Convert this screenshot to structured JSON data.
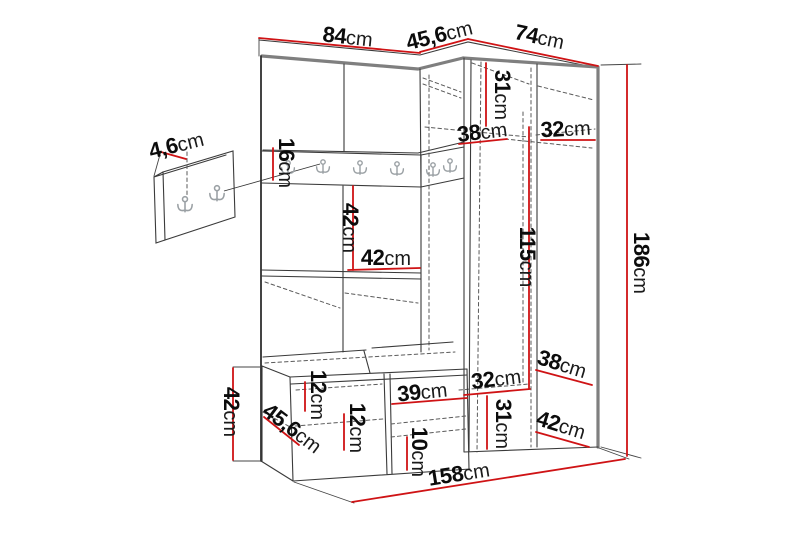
{
  "diagram": {
    "description": "Hallway furniture set dimension drawing",
    "unit": "cm",
    "labels": {
      "top_width_left": {
        "num": "84",
        "unit": "cm"
      },
      "top_width_corner": {
        "num": "45,6",
        "unit": "cm"
      },
      "top_width_right": {
        "num": "74",
        "unit": "cm"
      },
      "panel_depth": {
        "num": "4,6",
        "unit": "cm"
      },
      "rail_height": {
        "num": "16",
        "unit": "cm"
      },
      "upper_inner_height": {
        "num": "31",
        "unit": "cm"
      },
      "upper_shelf_left": {
        "num": "38",
        "unit": "cm"
      },
      "upper_shelf_right": {
        "num": "32",
        "unit": "cm"
      },
      "niche_height": {
        "num": "42",
        "unit": "cm"
      },
      "niche_width": {
        "num": "42",
        "unit": "cm"
      },
      "hanging_height": {
        "num": "115",
        "unit": "cm"
      },
      "total_height": {
        "num": "186",
        "unit": "cm"
      },
      "lower_shelf_left": {
        "num": "32",
        "unit": "cm"
      },
      "lower_shelf_right": {
        "num": "38",
        "unit": "cm"
      },
      "lower_inner_height": {
        "num": "31",
        "unit": "cm"
      },
      "lower_depth": {
        "num": "42",
        "unit": "cm"
      },
      "bench_height": {
        "num": "42",
        "unit": "cm"
      },
      "bench_depth": {
        "num": "45,6",
        "unit": "cm"
      },
      "bench_top_height": {
        "num": "12",
        "unit": "cm"
      },
      "bench_inner_height": {
        "num": "12",
        "unit": "cm"
      },
      "bench_door_width": {
        "num": "39",
        "unit": "cm"
      },
      "bench_shelf_height": {
        "num": "10",
        "unit": "cm"
      },
      "total_width": {
        "num": "158",
        "unit": "cm"
      }
    },
    "colors": {
      "dimension_line": "#cf1315",
      "edge": "#3a3a3a",
      "thick_edge": "#7f7f7f"
    }
  }
}
